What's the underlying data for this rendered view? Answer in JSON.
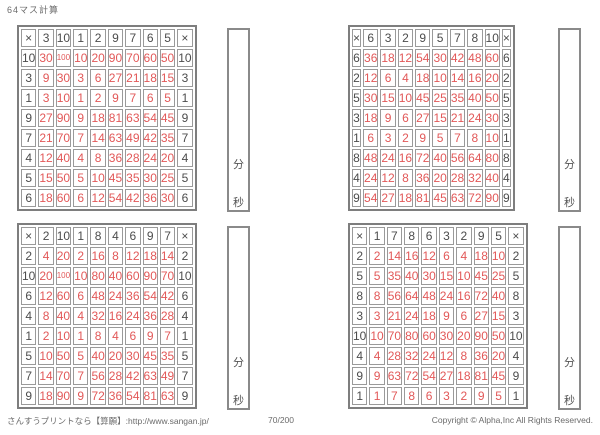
{
  "page_title": "64マス計算",
  "timer": {
    "minutes_label": "分",
    "seconds_label": "秒"
  },
  "footer": {
    "left": "さんすうプリントなら【算願】:http://www.sangan.jp/",
    "center": "70/200",
    "right": "Copyright © Alpha,Inc All Rights Reserved."
  },
  "colors": {
    "answer_red": "#e25858",
    "number_gray": "#4c4c4c",
    "grid_line": "#9a9a9a"
  },
  "grids": [
    {
      "position": "top-left",
      "operator": "×",
      "col_headers": [
        3,
        10,
        1,
        2,
        9,
        7,
        6,
        5
      ],
      "row_headers": [
        10,
        3,
        1,
        9,
        7,
        4,
        5,
        6
      ],
      "answers": [
        [
          30,
          100,
          10,
          20,
          90,
          70,
          60,
          50
        ],
        [
          9,
          30,
          3,
          6,
          27,
          21,
          18,
          15
        ],
        [
          3,
          10,
          1,
          2,
          9,
          7,
          6,
          5
        ],
        [
          27,
          90,
          9,
          18,
          81,
          63,
          54,
          45
        ],
        [
          21,
          70,
          7,
          14,
          63,
          49,
          42,
          35
        ],
        [
          12,
          40,
          4,
          8,
          36,
          28,
          24,
          20
        ],
        [
          15,
          50,
          5,
          10,
          45,
          35,
          30,
          25
        ],
        [
          18,
          60,
          6,
          12,
          54,
          42,
          36,
          30
        ]
      ]
    },
    {
      "position": "top-right",
      "operator": "×",
      "col_headers": [
        6,
        3,
        2,
        9,
        5,
        7,
        8,
        10
      ],
      "row_headers": [
        6,
        2,
        5,
        3,
        1,
        8,
        4,
        9
      ],
      "answers": [
        [
          36,
          18,
          12,
          54,
          30,
          42,
          48,
          60
        ],
        [
          12,
          6,
          4,
          18,
          10,
          14,
          16,
          20
        ],
        [
          30,
          15,
          10,
          45,
          25,
          35,
          40,
          50
        ],
        [
          18,
          9,
          6,
          27,
          15,
          21,
          24,
          30
        ],
        [
          6,
          3,
          2,
          9,
          5,
          7,
          8,
          10
        ],
        [
          48,
          24,
          16,
          72,
          40,
          56,
          64,
          80
        ],
        [
          24,
          12,
          8,
          36,
          20,
          28,
          32,
          40
        ],
        [
          54,
          27,
          18,
          81,
          45,
          63,
          72,
          90
        ]
      ]
    },
    {
      "position": "bottom-left",
      "operator": "×",
      "col_headers": [
        2,
        10,
        1,
        8,
        4,
        6,
        9,
        7
      ],
      "row_headers": [
        2,
        10,
        6,
        4,
        1,
        5,
        7,
        9
      ],
      "answers": [
        [
          4,
          20,
          2,
          16,
          8,
          12,
          18,
          14
        ],
        [
          20,
          100,
          10,
          80,
          40,
          60,
          90,
          70
        ],
        [
          12,
          60,
          6,
          48,
          24,
          36,
          54,
          42
        ],
        [
          8,
          40,
          4,
          32,
          16,
          24,
          36,
          28
        ],
        [
          2,
          10,
          1,
          8,
          4,
          6,
          9,
          7
        ],
        [
          10,
          50,
          5,
          40,
          20,
          30,
          45,
          35
        ],
        [
          14,
          70,
          7,
          56,
          28,
          42,
          63,
          49
        ],
        [
          18,
          90,
          9,
          72,
          36,
          54,
          81,
          63
        ]
      ]
    },
    {
      "position": "bottom-right",
      "operator": "×",
      "col_headers": [
        1,
        7,
        8,
        6,
        3,
        2,
        9,
        5
      ],
      "row_headers": [
        2,
        5,
        8,
        3,
        10,
        4,
        9,
        1
      ],
      "answers": [
        [
          2,
          14,
          16,
          12,
          6,
          4,
          18,
          10
        ],
        [
          5,
          35,
          40,
          30,
          15,
          10,
          45,
          25
        ],
        [
          8,
          56,
          64,
          48,
          24,
          16,
          72,
          40
        ],
        [
          3,
          21,
          24,
          18,
          9,
          6,
          27,
          15
        ],
        [
          10,
          70,
          80,
          60,
          30,
          20,
          90,
          50
        ],
        [
          4,
          28,
          32,
          24,
          12,
          8,
          36,
          20
        ],
        [
          9,
          63,
          72,
          54,
          27,
          18,
          81,
          45
        ],
        [
          1,
          7,
          8,
          6,
          3,
          2,
          9,
          5
        ]
      ]
    }
  ]
}
